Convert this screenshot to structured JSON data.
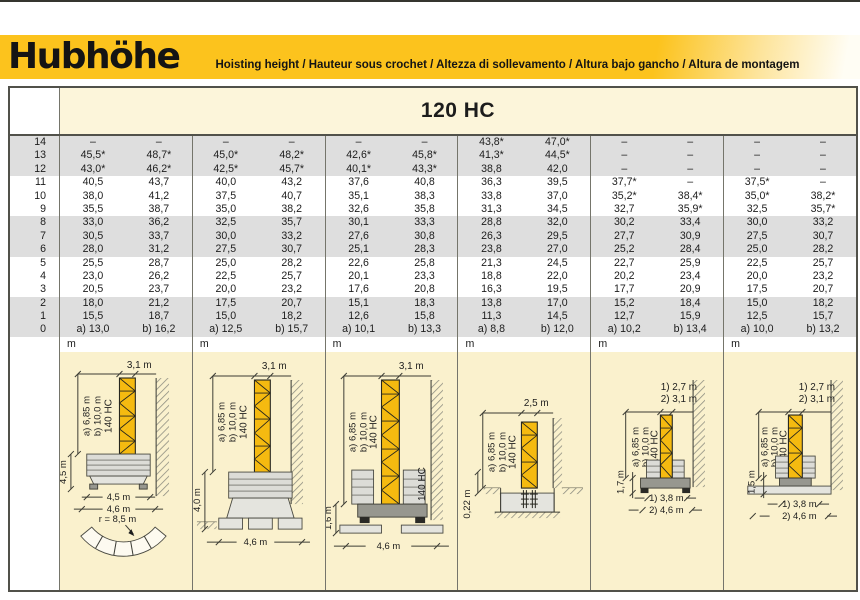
{
  "header": {
    "title": "Hubhöhe",
    "subtitle": "Hoisting height / Hauteur sous crochet / Altezza di sollevamento / Altura bajo gancho / Altura de montagem"
  },
  "colors": {
    "banner_yellow": "#FCC31D",
    "band_gray": "#DEDEDE",
    "table_cream": "#FCF5DA",
    "diagram_cream": "#FAF1CD",
    "mast_yellow": "#F5BA10"
  },
  "table": {
    "model": "120 HC",
    "unit": "m",
    "rows": [
      {
        "level": "14",
        "cells": [
          [
            "–",
            "–"
          ],
          [
            "–",
            "–"
          ],
          [
            "–",
            "–"
          ],
          [
            "43,8*",
            "47,0*"
          ],
          [
            "–",
            "–"
          ],
          [
            "–",
            "–"
          ]
        ]
      },
      {
        "level": "13",
        "cells": [
          [
            "45,5*",
            "48,7*"
          ],
          [
            "45,0*",
            "48,2*"
          ],
          [
            "42,6*",
            "45,8*"
          ],
          [
            "41,3*",
            "44,5*"
          ],
          [
            "–",
            "–"
          ],
          [
            "–",
            "–"
          ]
        ]
      },
      {
        "level": "12",
        "cells": [
          [
            "43,0*",
            "46,2*"
          ],
          [
            "42,5*",
            "45,7*"
          ],
          [
            "40,1*",
            "43,3*"
          ],
          [
            "38,8",
            "42,0"
          ],
          [
            "–",
            "–"
          ],
          [
            "–",
            "–"
          ]
        ]
      },
      {
        "level": "11",
        "cells": [
          [
            "40,5",
            "43,7"
          ],
          [
            "40,0",
            "43,2"
          ],
          [
            "37,6",
            "40,8"
          ],
          [
            "36,3",
            "39,5"
          ],
          [
            "37,7*",
            "–"
          ],
          [
            "37,5*",
            "–"
          ]
        ]
      },
      {
        "level": "10",
        "cells": [
          [
            "38,0",
            "41,2"
          ],
          [
            "37,5",
            "40,7"
          ],
          [
            "35,1",
            "38,3"
          ],
          [
            "33,8",
            "37,0"
          ],
          [
            "35,2*",
            "38,4*"
          ],
          [
            "35,0*",
            "38,2*"
          ]
        ]
      },
      {
        "level": "9",
        "cells": [
          [
            "35,5",
            "38,7"
          ],
          [
            "35,0",
            "38,2"
          ],
          [
            "32,6",
            "35,8"
          ],
          [
            "31,3",
            "34,5"
          ],
          [
            "32,7",
            "35,9*"
          ],
          [
            "32,5",
            "35,7*"
          ]
        ]
      },
      {
        "level": "8",
        "cells": [
          [
            "33,0",
            "36,2"
          ],
          [
            "32,5",
            "35,7"
          ],
          [
            "30,1",
            "33,3"
          ],
          [
            "28,8",
            "32,0"
          ],
          [
            "30,2",
            "33,4"
          ],
          [
            "30,0",
            "33,2"
          ]
        ]
      },
      {
        "level": "7",
        "cells": [
          [
            "30,5",
            "33,7"
          ],
          [
            "30,0",
            "33,2"
          ],
          [
            "27,6",
            "30,8"
          ],
          [
            "26,3",
            "29,5"
          ],
          [
            "27,7",
            "30,9"
          ],
          [
            "27,5",
            "30,7"
          ]
        ]
      },
      {
        "level": "6",
        "cells": [
          [
            "28,0",
            "31,2"
          ],
          [
            "27,5",
            "30,7"
          ],
          [
            "25,1",
            "28,3"
          ],
          [
            "23,8",
            "27,0"
          ],
          [
            "25,2",
            "28,4"
          ],
          [
            "25,0",
            "28,2"
          ]
        ]
      },
      {
        "level": "5",
        "cells": [
          [
            "25,5",
            "28,7"
          ],
          [
            "25,0",
            "28,2"
          ],
          [
            "22,6",
            "25,8"
          ],
          [
            "21,3",
            "24,5"
          ],
          [
            "22,7",
            "25,9"
          ],
          [
            "22,5",
            "25,7"
          ]
        ]
      },
      {
        "level": "4",
        "cells": [
          [
            "23,0",
            "26,2"
          ],
          [
            "22,5",
            "25,7"
          ],
          [
            "20,1",
            "23,3"
          ],
          [
            "18,8",
            "22,0"
          ],
          [
            "20,2",
            "23,4"
          ],
          [
            "20,0",
            "23,2"
          ]
        ]
      },
      {
        "level": "3",
        "cells": [
          [
            "20,5",
            "23,7"
          ],
          [
            "20,0",
            "23,2"
          ],
          [
            "17,6",
            "20,8"
          ],
          [
            "16,3",
            "19,5"
          ],
          [
            "17,7",
            "20,9"
          ],
          [
            "17,5",
            "20,7"
          ]
        ]
      },
      {
        "level": "2",
        "cells": [
          [
            "18,0",
            "21,2"
          ],
          [
            "17,5",
            "20,7"
          ],
          [
            "15,1",
            "18,3"
          ],
          [
            "13,8",
            "17,0"
          ],
          [
            "15,2",
            "18,4"
          ],
          [
            "15,0",
            "18,2"
          ]
        ]
      },
      {
        "level": "1",
        "cells": [
          [
            "15,5",
            "18,7"
          ],
          [
            "15,0",
            "18,2"
          ],
          [
            "12,6",
            "15,8"
          ],
          [
            "11,3",
            "14,5"
          ],
          [
            "12,7",
            "15,9"
          ],
          [
            "12,5",
            "15,7"
          ]
        ]
      },
      {
        "level": "0",
        "cells": [
          [
            "a) 13,0",
            "b) 16,2"
          ],
          [
            "a) 12,5",
            "b) 15,7"
          ],
          [
            "a) 10,1",
            "b) 13,3"
          ],
          [
            "a) 8,8",
            "b) 12,0"
          ],
          [
            "a) 10,2",
            "b) 13,4"
          ],
          [
            "a) 10,0",
            "b) 13,2"
          ]
        ]
      }
    ]
  },
  "diagrams": [
    {
      "top_width": "3,1 m",
      "height_a": "a) 6,85 m",
      "height_b": "b) 10,0 m",
      "mast_type": "140 HC",
      "base_height": "4,5 m",
      "base_width": "4,5 m",
      "overall_width": "4,6 m",
      "slew_radius": "r = 8,5 m"
    },
    {
      "top_width": "3,1 m",
      "height_a": "a) 6,85 m",
      "height_b": "b) 10,0 m",
      "mast_type": "140 HC",
      "base_height": "4,0 m",
      "overall_width": "4,6 m"
    },
    {
      "top_width": "3,1 m",
      "height_a": "a) 6,85 m",
      "height_b": "b) 10,0 m",
      "mast_type": "140 HC",
      "base_type": "140 HC",
      "base_height": "1,6 m",
      "overall_width": "4,6 m"
    },
    {
      "top_width": "2,5 m",
      "height_a": "a) 6,85 m",
      "height_b": "b) 10,0 m",
      "mast_type": "140 HC",
      "base_height": "0,22 m"
    },
    {
      "top_width_1": "1) 2,7 m",
      "top_width_2": "2) 3,1 m",
      "height_a": "a) 6,85 m",
      "height_b": "b) 10,0 m",
      "mast_type": "140 HC",
      "base_height": "1,7 m",
      "base_width_1": "1) 3,8 m",
      "base_width_2": "2) 4,6 m"
    },
    {
      "top_width_1": "1) 2,7 m",
      "top_width_2": "2) 3,1 m",
      "height_a": "a) 6,85 m",
      "height_b": "b) 10,0 m",
      "mast_type": "140 HC",
      "base_height": "1,5 m",
      "base_width_1": "1) 3,8 m",
      "base_width_2": "2) 4,6 m"
    }
  ]
}
